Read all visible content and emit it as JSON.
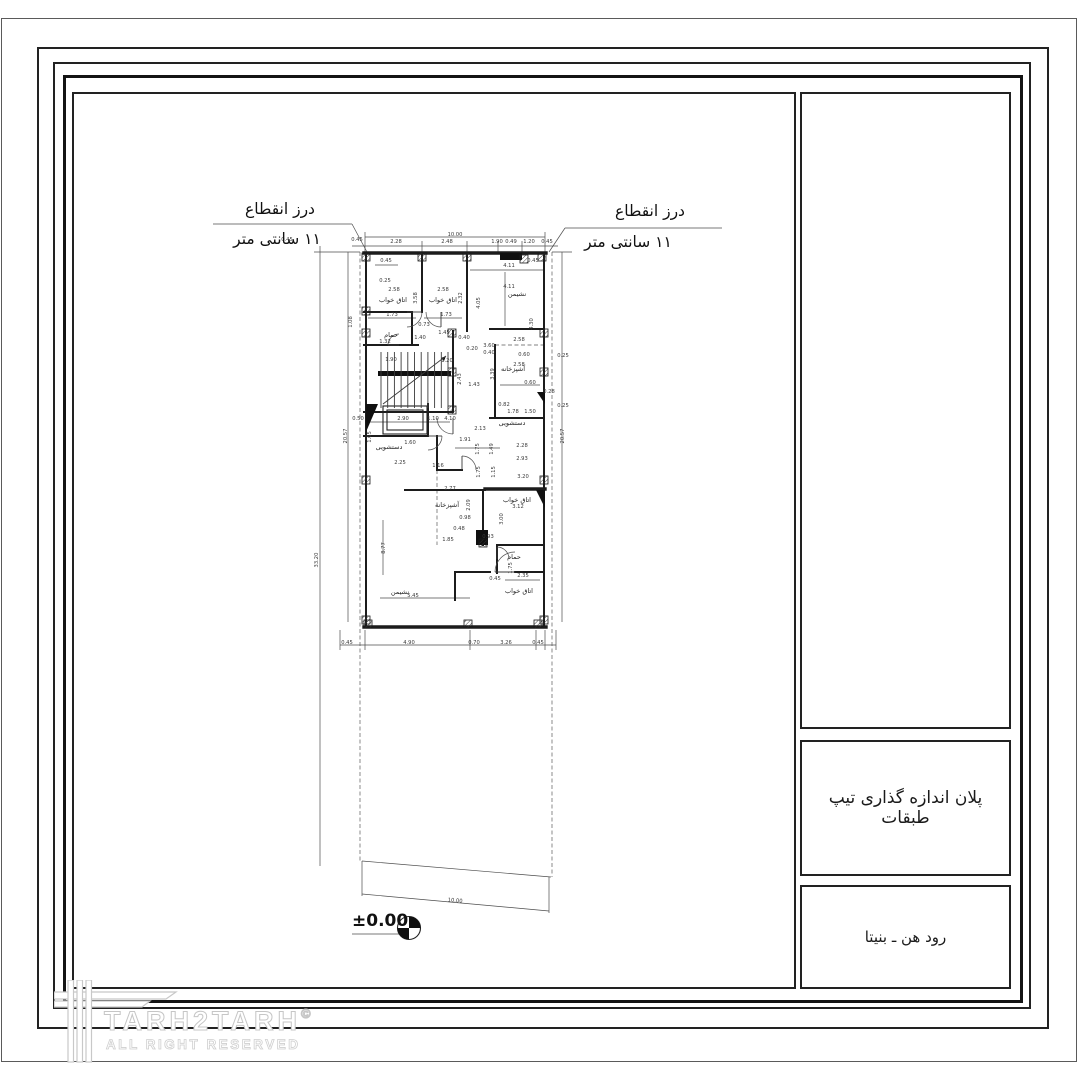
{
  "title_block": {
    "north_label": "NORTH",
    "plan_title": "پلان اندازه گذاری تیپ طبقات",
    "project_name": "رود هن ـ بنیتا"
  },
  "watermark": {
    "brand": "TARH2TARH",
    "copyright": "©",
    "subtitle": "ALL RIGHT RESERVED"
  },
  "plan": {
    "notes": [
      [
        280,
        214,
        "درز انقطاع"
      ],
      [
        277,
        244,
        "۱۱ سانتی متر"
      ],
      [
        650,
        216,
        "درز انقطاع"
      ],
      [
        628,
        247,
        "۱۱ سانتی متر"
      ]
    ],
    "level": {
      "x": 352,
      "y": 926,
      "label": "±0.00",
      "cx": 409,
      "cy": 928,
      "r": 11.5
    },
    "room_labels": [
      [
        393,
        302,
        "اتاق خواب"
      ],
      [
        443,
        302,
        "اتاق خواب"
      ],
      [
        517,
        296,
        "نشیمن"
      ],
      [
        391,
        337,
        "حمام"
      ],
      [
        513,
        371,
        "آشپزخانه"
      ],
      [
        512,
        425,
        "دستشویی"
      ],
      [
        389,
        449,
        "دستشویی"
      ],
      [
        447,
        507,
        "آشپزخانه"
      ],
      [
        517,
        502,
        "اتاق خواب"
      ],
      [
        514,
        559,
        "حمام"
      ],
      [
        400,
        594,
        "نشیمن"
      ],
      [
        519,
        593,
        "اتاق خواب"
      ]
    ],
    "dim_labels": [
      [
        455,
        236,
        "10.00"
      ],
      [
        396,
        243,
        "2.28"
      ],
      [
        447,
        243,
        "2.48"
      ],
      [
        497,
        243,
        "1.90"
      ],
      [
        511,
        243,
        "0.49"
      ],
      [
        529,
        243,
        "1.20"
      ],
      [
        547,
        243,
        "0.45"
      ],
      [
        287,
        241,
        "0.45"
      ],
      [
        357,
        241,
        "0.45"
      ],
      [
        386,
        262,
        "0.45"
      ],
      [
        385,
        282,
        "0.25"
      ],
      [
        509,
        267,
        "4.11"
      ],
      [
        533,
        262,
        "0.45"
      ],
      [
        394,
        291,
        "2.58"
      ],
      [
        417,
        298,
        "3.58",
        90
      ],
      [
        443,
        291,
        "2.58"
      ],
      [
        462,
        298,
        "2.32",
        90
      ],
      [
        480,
        303,
        "4.05",
        90
      ],
      [
        509,
        288,
        "4.11"
      ],
      [
        533,
        324,
        "4.30",
        90
      ],
      [
        392,
        316,
        "1.73"
      ],
      [
        446,
        316,
        "1.73"
      ],
      [
        424,
        326,
        "0.73"
      ],
      [
        464,
        339,
        "0.40"
      ],
      [
        352,
        322,
        "1.08",
        90
      ],
      [
        385,
        343,
        "1.32"
      ],
      [
        420,
        339,
        "1.40"
      ],
      [
        444,
        334,
        "1.45"
      ],
      [
        472,
        350,
        "0.20"
      ],
      [
        489,
        347,
        "3.60"
      ],
      [
        489,
        354,
        "0.40"
      ],
      [
        519,
        341,
        "2.58"
      ],
      [
        524,
        356,
        "0.60"
      ],
      [
        563,
        357,
        "0.25"
      ],
      [
        519,
        366,
        "2.58"
      ],
      [
        494,
        374,
        "3.39",
        90
      ],
      [
        391,
        361,
        "1.90"
      ],
      [
        447,
        362,
        "1.20"
      ],
      [
        461,
        379,
        "2.43",
        90
      ],
      [
        474,
        386,
        "1.43"
      ],
      [
        530,
        384,
        "0.60"
      ],
      [
        549,
        393,
        "0.28"
      ],
      [
        563,
        407,
        "0.25"
      ],
      [
        358,
        420,
        "0.50"
      ],
      [
        403,
        420,
        "2.90"
      ],
      [
        433,
        420,
        "1.10"
      ],
      [
        450,
        420,
        "4.10"
      ],
      [
        504,
        406,
        "0.82"
      ],
      [
        513,
        413,
        "1.78"
      ],
      [
        530,
        413,
        "1.50"
      ],
      [
        480,
        430,
        "2.13"
      ],
      [
        371,
        437,
        "1.65",
        90
      ],
      [
        410,
        444,
        "1.60"
      ],
      [
        465,
        441,
        "1.91"
      ],
      [
        479,
        449,
        "1.75",
        90
      ],
      [
        493,
        449,
        "1.49",
        90
      ],
      [
        522,
        447,
        "2.28"
      ],
      [
        522,
        460,
        "2.93"
      ],
      [
        400,
        464,
        "2.25"
      ],
      [
        438,
        467,
        "1.16"
      ],
      [
        480,
        472,
        "1.75",
        90
      ],
      [
        495,
        472,
        "1.15",
        90
      ],
      [
        523,
        478,
        "3.20"
      ],
      [
        450,
        490,
        "2.77"
      ],
      [
        470,
        505,
        "2.09",
        90
      ],
      [
        518,
        508,
        "3.12"
      ],
      [
        503,
        519,
        "3.00",
        90
      ],
      [
        465,
        519,
        "0.98"
      ],
      [
        459,
        530,
        "0.48"
      ],
      [
        448,
        541,
        "1.85"
      ],
      [
        488,
        538,
        "0.93"
      ],
      [
        385,
        548,
        "8.77",
        90
      ],
      [
        512,
        568,
        "1.75",
        90
      ],
      [
        495,
        580,
        "0.45"
      ],
      [
        523,
        577,
        "2.35"
      ],
      [
        413,
        597,
        "5.45"
      ],
      [
        347,
        436,
        "20.57",
        90
      ],
      [
        564,
        436,
        "20.57",
        90
      ],
      [
        318,
        560,
        "33.20",
        90
      ],
      [
        347,
        644,
        "0.45"
      ],
      [
        409,
        644,
        "4.90"
      ],
      [
        474,
        644,
        "0.70"
      ],
      [
        506,
        644,
        "3.26"
      ],
      [
        538,
        644,
        "0.45"
      ],
      [
        455,
        902,
        "10.00",
        5
      ]
    ],
    "walls": [
      [
        364,
        253,
        546,
        253
      ],
      [
        364,
        627,
        546,
        627
      ],
      [
        485,
        489,
        545,
        489
      ]
    ],
    "wallsmed": [
      [
        366,
        253,
        366,
        627
      ],
      [
        544,
        253,
        544,
        627
      ],
      [
        422,
        253,
        422,
        312
      ],
      [
        467,
        253,
        467,
        331
      ],
      [
        364,
        312,
        412,
        312
      ],
      [
        364,
        345,
        418,
        345
      ],
      [
        412,
        312,
        412,
        345
      ],
      [
        490,
        329,
        544,
        329
      ],
      [
        495,
        345,
        495,
        418
      ],
      [
        490,
        418,
        544,
        418
      ],
      [
        453,
        331,
        453,
        412
      ],
      [
        364,
        412,
        453,
        412
      ],
      [
        428,
        404,
        428,
        436
      ],
      [
        364,
        436,
        428,
        436
      ],
      [
        405,
        490,
        485,
        490
      ],
      [
        483,
        490,
        483,
        545
      ],
      [
        497,
        545,
        544,
        545
      ],
      [
        497,
        545,
        497,
        573
      ],
      [
        455,
        572,
        490,
        572
      ],
      [
        515,
        572,
        544,
        572
      ],
      [
        455,
        572,
        455,
        600
      ],
      [
        437,
        436,
        437,
        470
      ],
      [
        437,
        470,
        462,
        470
      ]
    ],
    "thin": [
      [
        365,
        237,
        545,
        237
      ],
      [
        352,
        246,
        558,
        246
      ],
      [
        320,
        246,
        320,
        866
      ],
      [
        348,
        252,
        348,
        622
      ],
      [
        562,
        252,
        562,
        622
      ],
      [
        340,
        645,
        556,
        645
      ],
      [
        213,
        224,
        352,
        224
      ],
      [
        352,
        224,
        367,
        252
      ],
      [
        565,
        228,
        722,
        228
      ],
      [
        565,
        228,
        549,
        252
      ],
      [
        352,
        934,
        400,
        934
      ],
      [
        362,
        861,
        551,
        877
      ],
      [
        362,
        894,
        549,
        911
      ],
      [
        362,
        861,
        362,
        896
      ],
      [
        549,
        877,
        549,
        913
      ],
      [
        314,
        252,
        360,
        252
      ],
      [
        552,
        252,
        572,
        252
      ],
      [
        365,
        232,
        365,
        253
      ],
      [
        422,
        241,
        422,
        253
      ],
      [
        467,
        241,
        467,
        253
      ],
      [
        522,
        241,
        522,
        253
      ],
      [
        545,
        232,
        545,
        253
      ],
      [
        498,
        241,
        498,
        253
      ],
      [
        340,
        630,
        340,
        650
      ],
      [
        365,
        630,
        365,
        650
      ],
      [
        470,
        630,
        470,
        650
      ],
      [
        536,
        630,
        536,
        650
      ],
      [
        545,
        630,
        545,
        650
      ],
      [
        556,
        630,
        556,
        650
      ],
      [
        375,
        265,
        398,
        265
      ],
      [
        470,
        270,
        543,
        270
      ],
      [
        368,
        318,
        416,
        318
      ],
      [
        424,
        318,
        462,
        318
      ],
      [
        505,
        272,
        505,
        326
      ],
      [
        500,
        385,
        540,
        385
      ],
      [
        370,
        422,
        450,
        422
      ],
      [
        455,
        448,
        500,
        448
      ],
      [
        383,
        520,
        383,
        575
      ],
      [
        505,
        580,
        540,
        580
      ],
      [
        380,
        598,
        470,
        598
      ]
    ],
    "dashed": [
      [
        360,
        252,
        360,
        861
      ],
      [
        552,
        252,
        552,
        877
      ],
      [
        495,
        345,
        544,
        345
      ],
      [
        437,
        470,
        437,
        545
      ]
    ],
    "cols": [
      [
        366,
        257
      ],
      [
        422,
        257
      ],
      [
        467,
        257
      ],
      [
        524,
        259
      ],
      [
        542,
        257
      ],
      [
        366,
        311
      ],
      [
        366,
        333
      ],
      [
        366,
        480
      ],
      [
        366,
        620
      ],
      [
        544,
        333
      ],
      [
        544,
        372
      ],
      [
        544,
        480
      ],
      [
        544,
        620
      ],
      [
        368,
        624
      ],
      [
        468,
        624
      ],
      [
        538,
        624
      ],
      [
        452,
        333
      ],
      [
        452,
        372
      ],
      [
        452,
        410
      ],
      [
        483,
        543
      ]
    ],
    "solids": [
      "366,404 378,404 366,432",
      "537,392 545,392 545,404",
      "536,490 545,490 545,508",
      "476,530 488,530 488,545 476,545",
      "378,371 451,371 451,376 378,376",
      "500,253 522,253 522,260 500,260",
      "446,356 441,358 444,361"
    ],
    "arcs": [
      [
        407,
        312,
        15,
        0,
        90
      ],
      [
        441,
        312,
        15,
        90,
        180
      ],
      [
        399,
        345,
        11,
        180,
        270
      ],
      [
        453,
        418,
        16,
        90,
        180
      ],
      [
        462,
        470,
        14,
        270,
        360
      ],
      [
        497,
        559,
        12,
        270,
        360
      ],
      [
        515,
        572,
        20,
        180,
        270
      ],
      [
        428,
        436,
        14,
        0,
        90
      ]
    ],
    "rects": [
      [
        383,
        406,
        44,
        28
      ],
      [
        387,
        410,
        36,
        20
      ]
    ],
    "stairs": {
      "x0": 381,
      "x1": 448,
      "y0": 352,
      "y1": 408,
      "n": 11
    },
    "stair_diag": [
      383,
      404,
      446,
      356
    ]
  }
}
